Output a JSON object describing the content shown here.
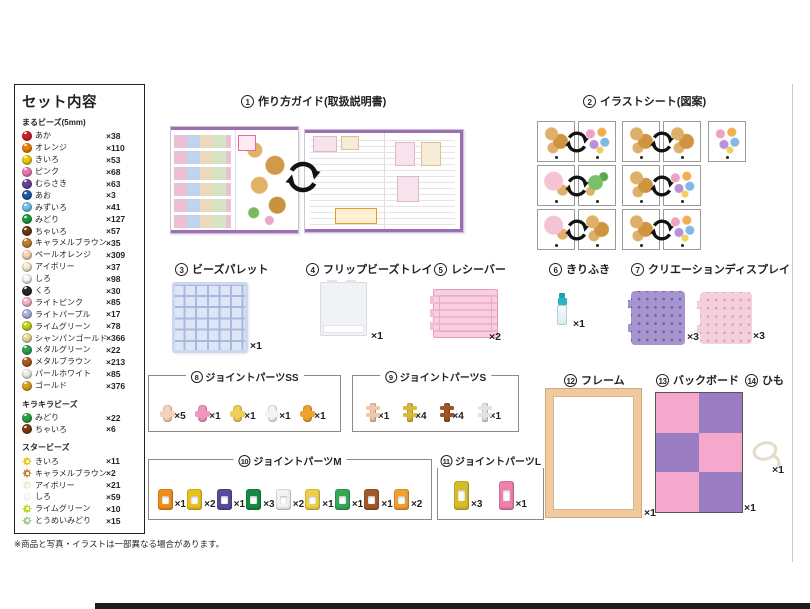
{
  "sidebar": {
    "title": "セット内容",
    "sections": [
      {
        "heading": "まるビーズ(5mm)",
        "items": [
          {
            "name": "あか",
            "count": "×38",
            "color": "#cc2229"
          },
          {
            "name": "オレンジ",
            "count": "×110",
            "color": "#ef8200"
          },
          {
            "name": "きいろ",
            "count": "×53",
            "color": "#f2cc0c"
          },
          {
            "name": "ピンク",
            "count": "×68",
            "color": "#ee7bb4"
          },
          {
            "name": "むらさき",
            "count": "×63",
            "color": "#6c4198"
          },
          {
            "name": "あお",
            "count": "×3",
            "color": "#1f5aa8"
          },
          {
            "name": "みずいろ",
            "count": "×41",
            "color": "#79c2e8"
          },
          {
            "name": "みどり",
            "count": "×127",
            "color": "#1f9e3c"
          },
          {
            "name": "ちゃいろ",
            "count": "×57",
            "color": "#6b3a17"
          },
          {
            "name": "キャラメルブラウン",
            "count": "×35",
            "color": "#bf8136"
          },
          {
            "name": "ペールオレンジ",
            "count": "×309",
            "color": "#f6d6b4"
          },
          {
            "name": "アイボリー",
            "count": "×37",
            "color": "#f3ecd4"
          },
          {
            "name": "しろ",
            "count": "×98",
            "color": "#f8f8f6"
          },
          {
            "name": "くろ",
            "count": "×30",
            "color": "#2a2a2a"
          },
          {
            "name": "ライトピンク",
            "count": "×85",
            "color": "#f3b5cf"
          },
          {
            "name": "ライトパープル",
            "count": "×17",
            "color": "#aab4e2"
          },
          {
            "name": "ライムグリーン",
            "count": "×78",
            "color": "#c3d11f"
          },
          {
            "name": "シャンパンゴールド",
            "count": "×366",
            "color": "#e9da96"
          },
          {
            "name": "メタルグリーン",
            "count": "×22",
            "color": "#2fa050"
          },
          {
            "name": "メタルブラウン",
            "count": "×213",
            "color": "#b05a1e"
          },
          {
            "name": "パールホワイト",
            "count": "×85",
            "color": "#efefe9"
          },
          {
            "name": "ゴールド",
            "count": "×376",
            "color": "#d9a31c"
          }
        ]
      },
      {
        "heading": "キラキラビーズ",
        "items": [
          {
            "name": "みどり",
            "count": "×22",
            "color": "#28a244"
          },
          {
            "name": "ちゃいろ",
            "count": "×6",
            "color": "#7c3c0e"
          }
        ]
      },
      {
        "heading": "スタービーズ",
        "items": [
          {
            "name": "きいろ",
            "count": "×11",
            "color": "#e9c514"
          },
          {
            "name": "キャラメルブラウン",
            "count": "×2",
            "color": "#bf8136"
          },
          {
            "name": "アイボリー",
            "count": "×21",
            "color": "#efe8cc"
          },
          {
            "name": "しろ",
            "count": "×59",
            "color": "#f2f2ee"
          },
          {
            "name": "ライムグリーン",
            "count": "×10",
            "color": "#c3d11f"
          },
          {
            "name": "とうめいみどり",
            "count": "×15",
            "color": "#9cc98a"
          }
        ]
      }
    ]
  },
  "items": {
    "guide": {
      "num": "1",
      "label": "作り方ガイド(取扱説明書)"
    },
    "sheet": {
      "num": "2",
      "label": "イラストシート(図案)"
    },
    "palette": {
      "num": "3",
      "label": "ビーズパレット",
      "count": "×1"
    },
    "tray": {
      "num": "4",
      "label": "フリップビーズトレイ",
      "count": "×1"
    },
    "receiver": {
      "num": "5",
      "label": "レシーバー",
      "count": "×2"
    },
    "spray": {
      "num": "6",
      "label": "きりふき",
      "count": "×1"
    },
    "display": {
      "num": "7",
      "label": "クリエーションディスプレイ",
      "count_purple": "×3",
      "count_pink": "×3"
    },
    "joint_ss": {
      "num": "8",
      "label": "ジョイントパーツSS",
      "parts": [
        {
          "color": "#f6d2b8",
          "count": "×5"
        },
        {
          "color": "#f097c0",
          "count": "×1"
        },
        {
          "color": "#eecf5a",
          "count": "×1"
        },
        {
          "color": "#f3f3ef",
          "count": "×1"
        },
        {
          "color": "#efa22e",
          "count": "×1"
        }
      ]
    },
    "joint_s": {
      "num": "9",
      "label": "ジョイントパーツS",
      "parts": [
        {
          "color": "#f2c6a8",
          "count": "×1"
        },
        {
          "color": "#d6b93a",
          "count": "×4"
        },
        {
          "color": "#9e5426",
          "count": "×4"
        },
        {
          "color": "#e3e3df",
          "count": "×1"
        }
      ]
    },
    "joint_m": {
      "num": "10",
      "label": "ジョイントパーツM",
      "parts": [
        {
          "color": "#ef8c1a",
          "count": "×1"
        },
        {
          "color": "#e9c21d",
          "count": "×2"
        },
        {
          "color": "#5a4a9c",
          "count": "×1"
        },
        {
          "color": "#168a42",
          "count": "×3"
        },
        {
          "color": "#f2f2ee",
          "count": "×2"
        },
        {
          "color": "#ecd049",
          "count": "×1"
        },
        {
          "color": "#35a856",
          "count": "×1"
        },
        {
          "color": "#a2592a",
          "count": "×1"
        },
        {
          "color": "#f0a030",
          "count": "×2"
        }
      ]
    },
    "joint_l": {
      "num": "11",
      "label": "ジョイントパーツL",
      "parts": [
        {
          "color": "#d8bd2b",
          "count": "×3"
        },
        {
          "color": "#ee7fae",
          "count": "×1"
        }
      ]
    },
    "frame": {
      "num": "12",
      "label": "フレーム",
      "count": "×1"
    },
    "backboard": {
      "num": "13",
      "label": "バックボード",
      "count": "×1",
      "cells": [
        "#f4a8cb",
        "#9a7cc2",
        "#9a7cc2",
        "#f4a8cb",
        "#f4a8cb",
        "#9a7cc2"
      ]
    },
    "string": {
      "num": "14",
      "label": "ひも",
      "count": "×1"
    }
  },
  "note": "※商品と写真・イラストは一部異なる場合があります。"
}
